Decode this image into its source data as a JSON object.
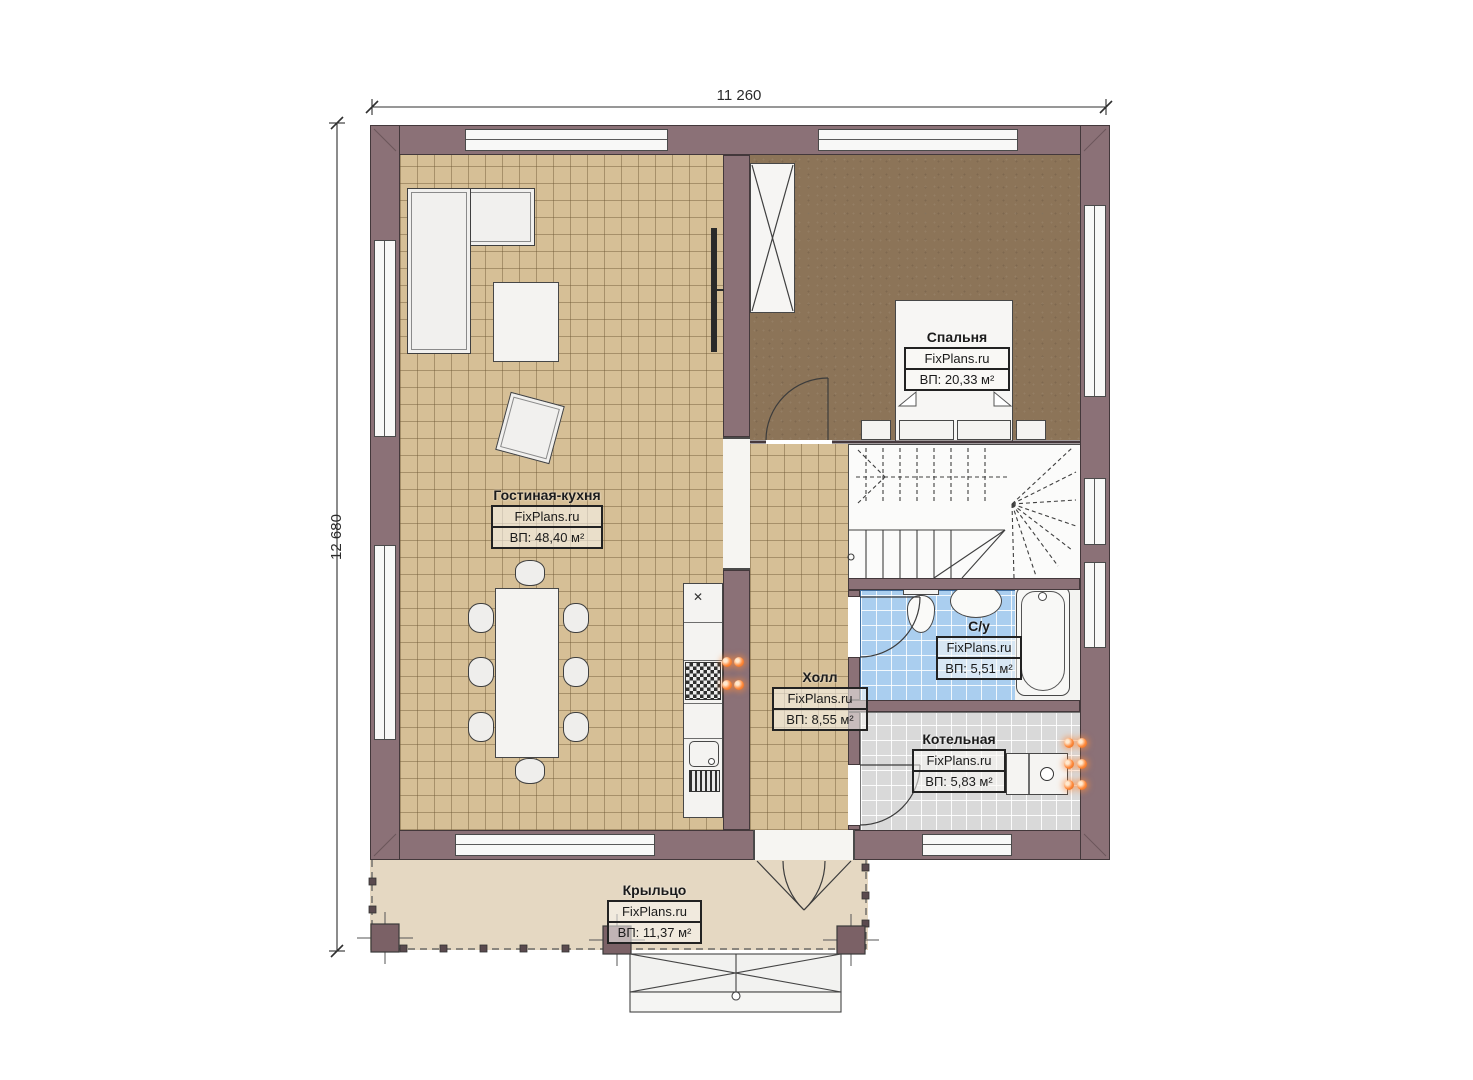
{
  "dimensions": {
    "width_label": "11 260",
    "height_label": "12 680"
  },
  "brand": "FixPlans.ru",
  "rooms": [
    {
      "key": "living",
      "name": "Гостиная-кухня",
      "brand": "FixPlans.ru",
      "area_label": "ВП: 48,40 м²"
    },
    {
      "key": "bedroom",
      "name": "Спальня",
      "brand": "FixPlans.ru",
      "area_label": "ВП: 20,33 м²"
    },
    {
      "key": "hall",
      "name": "Холл",
      "brand": "FixPlans.ru",
      "area_label": "ВП: 8,55 м²"
    },
    {
      "key": "bathroom",
      "name": "С/у",
      "brand": "FixPlans.ru",
      "area_label": "ВП: 5,51 м²"
    },
    {
      "key": "boiler",
      "name": "Котельная",
      "brand": "FixPlans.ru",
      "area_label": "ВП: 5,83 м²"
    },
    {
      "key": "porch",
      "name": "Крыльцо",
      "brand": "FixPlans.ru",
      "area_label": "ВП: 11,37 м²"
    }
  ],
  "icons": {
    "counter_cross": "✕"
  },
  "colors": {
    "wall": "#8b7177",
    "floor_living": "#d6bf96",
    "floor_bedroom": "#8c7458",
    "floor_bathroom": "#aaceef",
    "floor_boiler": "#d9d9d9",
    "floor_porch": "#e5d8c2",
    "radiator_orange": "#ff8a3c"
  }
}
